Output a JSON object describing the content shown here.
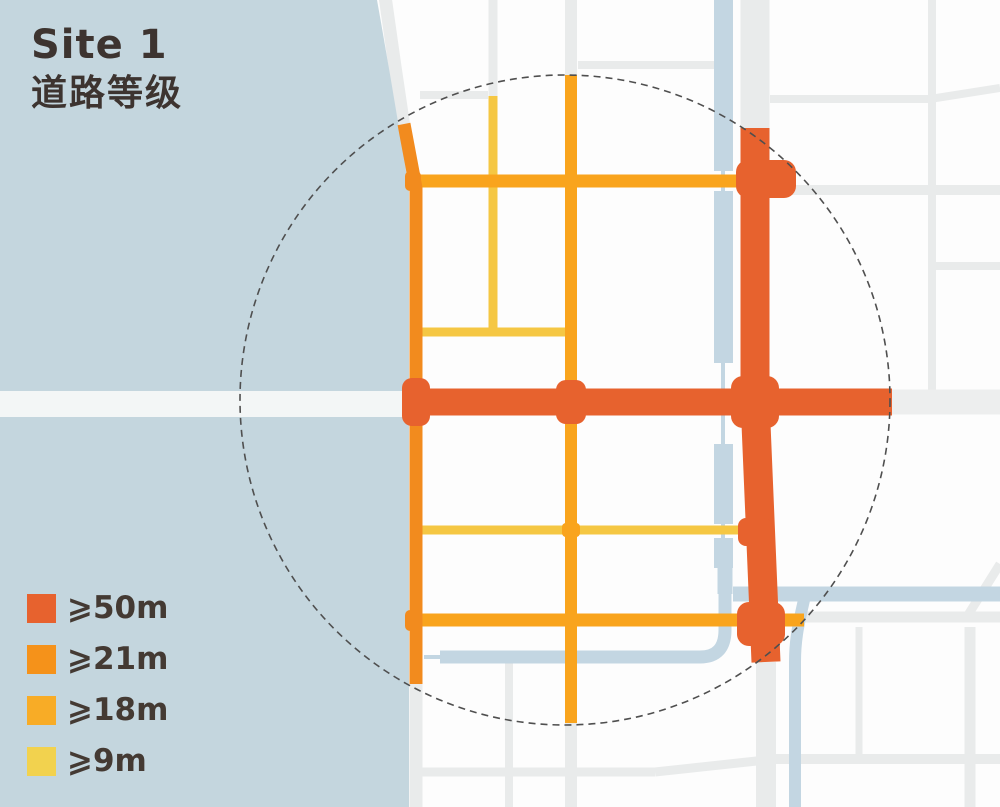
{
  "header": {
    "site_label": "Site 1",
    "subtitle": "道路等级"
  },
  "legend": {
    "items": [
      {
        "label": "⩾50m",
        "color": "#e7622e"
      },
      {
        "label": "⩾21m",
        "color": "#f5921a"
      },
      {
        "label": "⩾18m",
        "color": "#f8ac26"
      },
      {
        "label": "⩾9m",
        "color": "#f2d24e"
      }
    ]
  },
  "map": {
    "colors": {
      "water": "#c4d6de",
      "canal": "#c3d6e2",
      "minor_road": "#e9ebeb",
      "road_band_over_water": "#f3f6f6",
      "w50": "#e7622e",
      "w21": "#f28b1e",
      "w18": "#f9a41d",
      "w9": "#f5c743"
    },
    "study_circle": {
      "cx": 565,
      "cy": 400,
      "r": 325,
      "style": "dashed",
      "color": "#4f4f4f"
    }
  }
}
